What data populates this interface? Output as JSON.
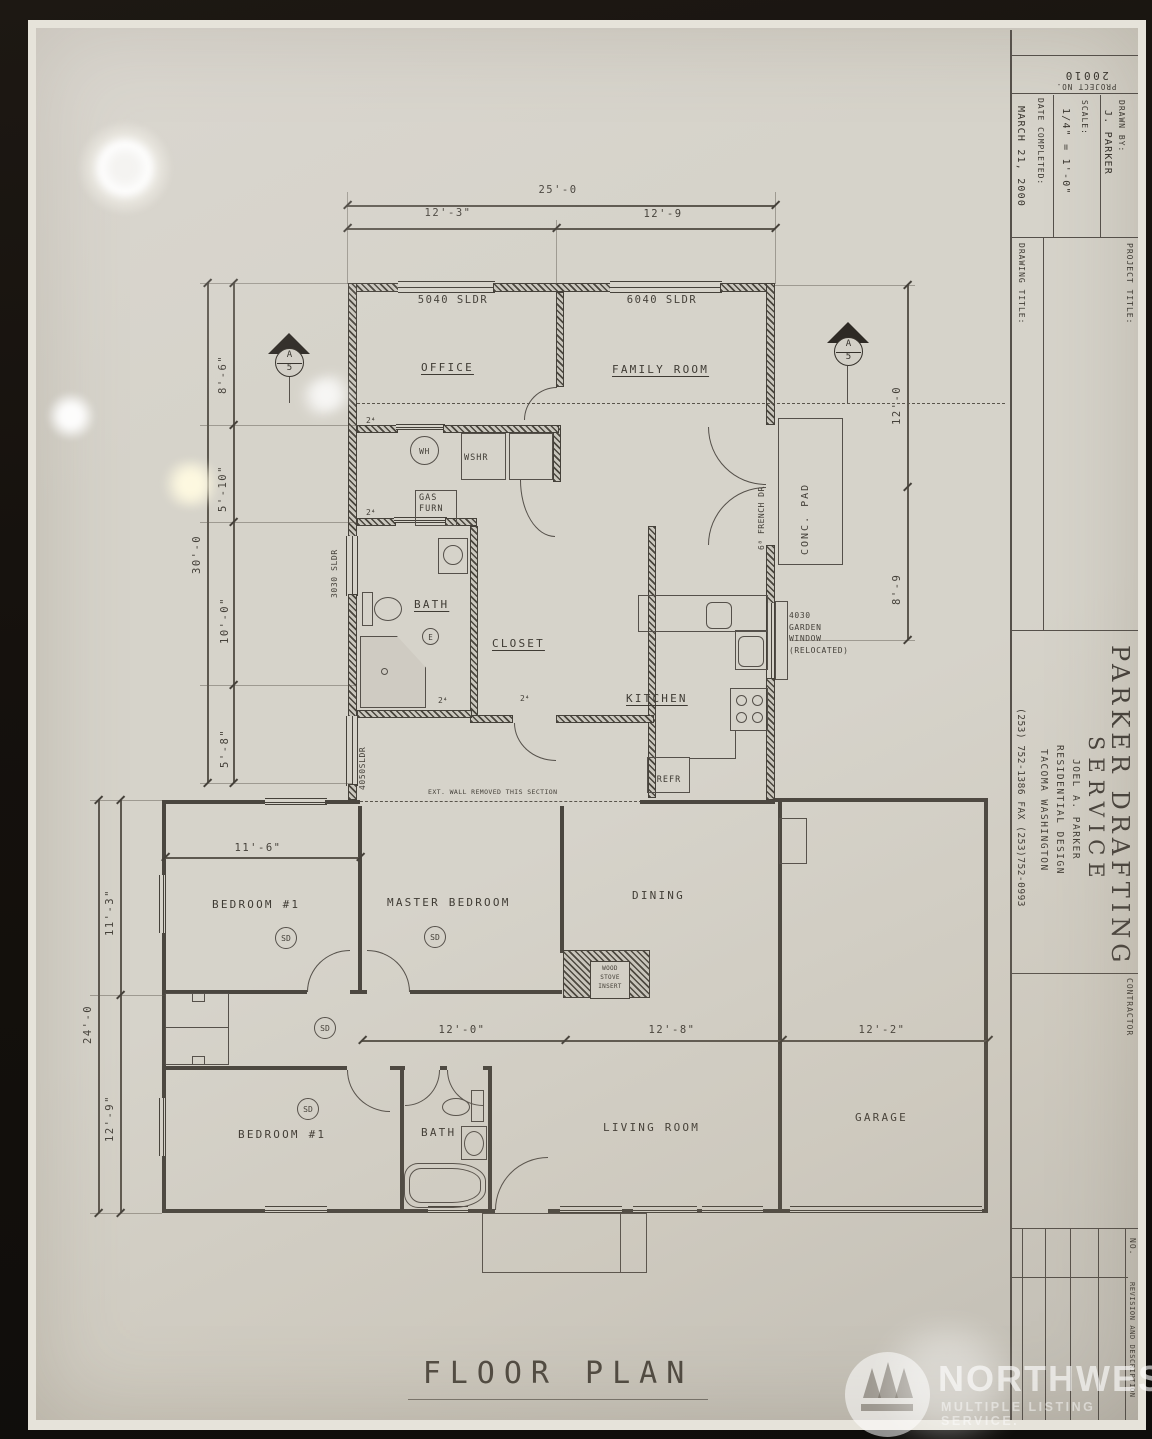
{
  "plan": {
    "title": "FLOOR PLAN",
    "rooms": {
      "office": "OFFICE",
      "family_room": "FAMILY ROOM",
      "bath_upper": "BATH",
      "closet": "CLOSET",
      "kitchen": "KITCHEN",
      "bedroom1_upper": "BEDROOM #1",
      "master_bedroom": "MASTER BEDROOM",
      "dining": "DINING",
      "bedroom1_lower": "BEDROOM #1",
      "bath_lower": "BATH",
      "living_room": "LIVING ROOM",
      "garage": "GARAGE"
    },
    "fixtures": {
      "water_heater": "WH",
      "washer": "WSHR",
      "dryer": "DRYR",
      "gas_furnace": "GAS\nFURN",
      "refrigerator": "REFR",
      "wood_stove": "WOOD\nSTOVE\nINSERT",
      "concrete_pad": "CONC. PAD",
      "smoke_detector": "SD",
      "electrical": "E"
    },
    "windows": {
      "w5040": "5040 SLDR",
      "w6040": "6040 SLDR",
      "w3030": "3030 SLDR",
      "w4050": "4050SLDR",
      "garden": "4030\nGARDEN\nWINDOW\n(RELOCATED)"
    },
    "doors": {
      "french": "6⁸ FRENCH DR",
      "d24": "2⁴"
    },
    "notes": {
      "ext_wall": "EXT. WALL REMOVED THIS SECTION"
    },
    "dims": {
      "top_overall": "25'-0",
      "top_left": "12'-3\"",
      "top_right": "12'-9",
      "left_overall": "30'-0",
      "left_1": "8'-6\"",
      "left_2": "5'-10\"",
      "left_3": "10'-0\"",
      "left_4": "5'-8\"",
      "right_1": "12'-0",
      "right_2": "8'-9",
      "bed1_width": "11'-6\"",
      "hall": "12'-0\"",
      "living": "12'-8\"",
      "garage": "12'-2\"",
      "lower_left_overall": "24'-0",
      "lower_left_1": "11'-3\"",
      "lower_left_2": "12'-9\""
    },
    "section_marker": {
      "letter": "A",
      "number": "5"
    }
  },
  "title_block": {
    "project_no_label": "PROJECT NO.",
    "project_no_value": "20010",
    "drawn_by_label": "DRAWN BY:",
    "drawn_by_value": "J. PARKER",
    "scale_label": "SCALE:",
    "scale_value": "1/4\" = 1'-0\"",
    "date_label": "DATE COMPLETED:",
    "date_value": "MARCH 21, 2000",
    "project_title_label": "PROJECT TITLE:",
    "drawing_title_label": "DRAWING TITLE:",
    "company_name_1": "PARKER DRAFTING",
    "company_name_2": "SERVICE",
    "company_owner": "JOEL A. PARKER",
    "company_line": "RESIDENTIAL DESIGN",
    "company_city": "TACOMA  WASHINGTON",
    "company_phone": "(253) 752-1386  FAX (253)752-0993",
    "contractor_label": "CONTRACTOR",
    "revision_no_label": "NO.",
    "revision_desc_label": "REVISION AND DESCRIPTION"
  },
  "watermark": {
    "name": "NORTHWEST",
    "subtitle": "MULTIPLE LISTING SERVICE."
  }
}
